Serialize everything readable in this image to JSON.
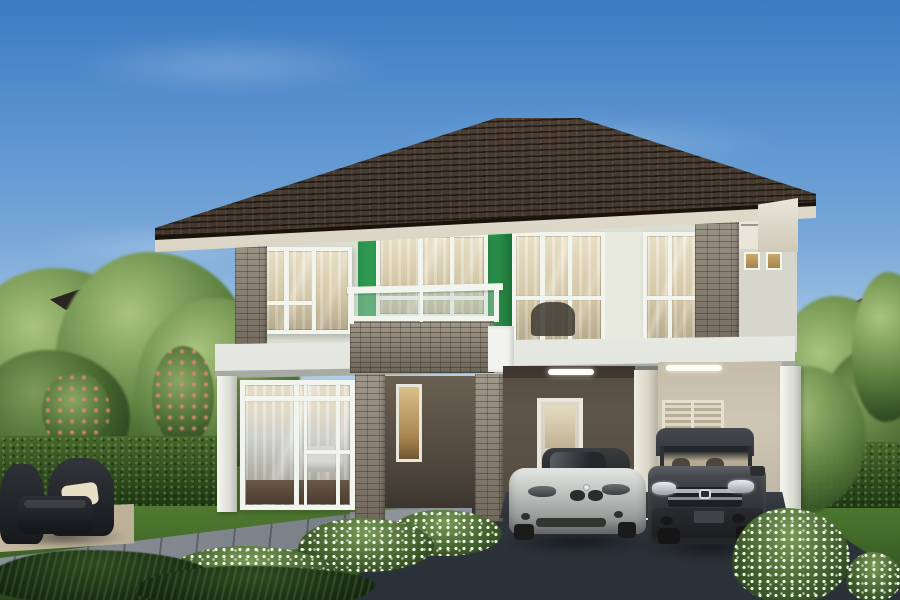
{
  "scene": {
    "description": "Photorealistic 3D architectural rendering of a modern two-storey detached house with a dark brown hip roof, a bright green accent wall panel, stone-clad pillars, a glass-railed balcony, and a double carport sheltering a silver convertible and a dark grey SUV, set in a landscaped garden with trimmed hedges, white flowering shrubs, a stone path and wicker patio furniture under a blue sky",
    "time_of_day": "daytime",
    "objects": [
      {
        "name": "house",
        "label": "two-storey modern house"
      },
      {
        "name": "roof",
        "label": "dark brown tiled hip roof with cream soffit"
      },
      {
        "name": "green-accent-panel",
        "label": "bright green feature wall around centre window"
      },
      {
        "name": "balcony",
        "label": "balcony with white railing, glass panels and stone parapet"
      },
      {
        "name": "stone-pillars",
        "label": "grey stack-stone clad pillars"
      },
      {
        "name": "carport",
        "label": "double carport with door and louvered utility doors"
      },
      {
        "name": "car-convertible",
        "label": "silver roadster convertible parked in carport"
      },
      {
        "name": "car-suv",
        "label": "dark grey SUV with chrome grille parked in carport"
      },
      {
        "name": "driveway",
        "label": "dark grey paved driveway"
      },
      {
        "name": "garden-path",
        "label": "grey stone garden path"
      },
      {
        "name": "patio-furniture",
        "label": "dark wicker armchairs and coffee table with cream cushion"
      },
      {
        "name": "hedges",
        "label": "trimmed box hedges"
      },
      {
        "name": "flower-bushes",
        "label": "white flowering shrubs along house and driveway"
      },
      {
        "name": "background",
        "label": "neighbouring houses and trees with pink blossoms"
      }
    ]
  },
  "palette": {
    "sky_top": "#3d7bc1",
    "sky_mid": "#79a8d8",
    "sky_low": "#c6dbec",
    "roof_hi": "#55463a",
    "roof_lo": "#271e17",
    "roof_edge": "#1a130c",
    "soffit_hi": "#f0ebdc",
    "soffit_lo": "#bcb6a4",
    "wall_light": "#dce0d4",
    "frame_white": "#f2f4ee",
    "green_accent": "#2f9b51",
    "green_dark": "#1f7a3c",
    "stone": "#8a8171",
    "slab_hi": "#f7f8f4",
    "slab_lo": "#d8dbd2",
    "taupe": "#5e5549",
    "beige": "#cfc7b4",
    "louver": "#b6ad97",
    "louver_hi": "#ded7c5",
    "glass_warm1": "#eee6cf",
    "glass_warm2": "#d9cdaf",
    "glass_warm3": "#b5a98c",
    "amber": "#c9a76b",
    "hedge_light": "#47682c",
    "hedge_dark": "#1e3814",
    "lawn_light": "#5d8437",
    "lawn_dark": "#2b471d",
    "drive_hi": "#59626c",
    "drive_lo": "#2b3138",
    "path_hi": "#8a9096",
    "path_lo": "#5d636b",
    "patio": "#bdb098",
    "car_silver_hi": "#e4e6e3",
    "car_silver_lo": "#838785",
    "car_dark_hi": "#4a4d52",
    "car_dark_lo": "#232528",
    "chrome": "#c9ced2",
    "furn_dark": "#24272b",
    "cushion": "#e8dfc6",
    "blossom_pink": "#d98a74"
  }
}
